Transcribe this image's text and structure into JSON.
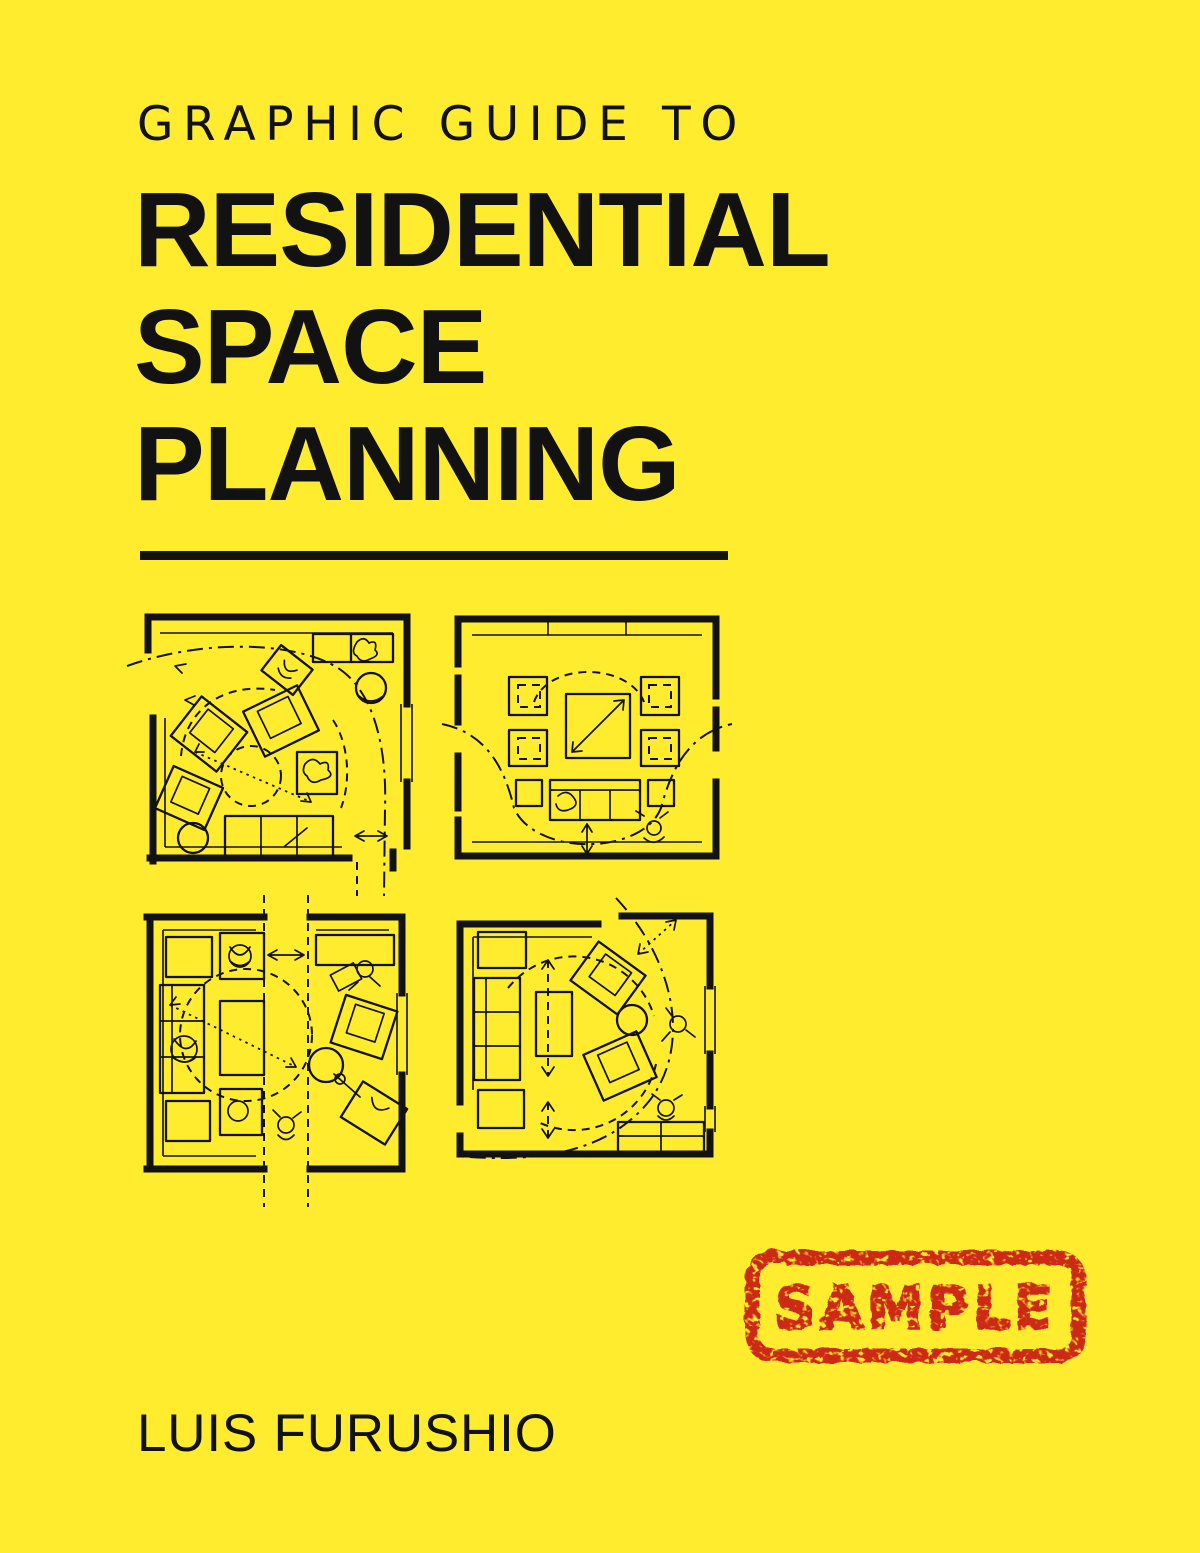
{
  "colors": {
    "background_yellow": "#FFEC2F",
    "ink_black": "#121212",
    "stamp_red": "#CC2B17"
  },
  "cover": {
    "kicker": "GRAPHIC GUIDE TO",
    "title_lines": [
      "RESIDENTIAL",
      "SPACE",
      "PLANNING"
    ],
    "author": "LUIS FURUSHIO",
    "stamp_label": "SAMPLE",
    "plan_icons": [
      "floor-plan-corner-living-room",
      "floor-plan-square-table-four-chairs",
      "floor-plan-split-corridor",
      "floor-plan-curved-circulation"
    ]
  }
}
